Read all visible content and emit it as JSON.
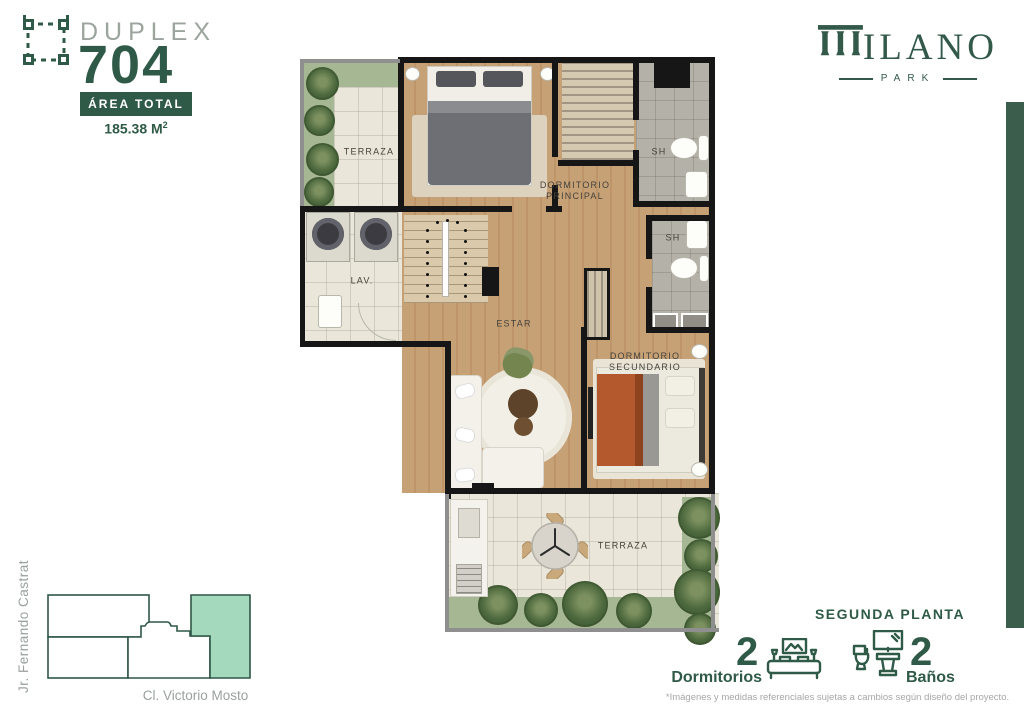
{
  "header": {
    "unit_type": "DUPLEX",
    "unit_number": "704",
    "area_label": "ÁREA TOTAL",
    "area_value": "185.38 M",
    "area_sup": "2",
    "icon": "plan-outline-icon"
  },
  "brand": {
    "name_initial": "M",
    "name_rest": "ILANO",
    "subtitle": "PARK",
    "color": "#33594a"
  },
  "floor_plan": {
    "rooms": {
      "terraza_top": "TERRAZA",
      "dormitorio_principal": [
        "DORMITORIO",
        "PRINCIPAL"
      ],
      "sh1": "SH",
      "sh2": "SH",
      "lavanderia": "LAV.",
      "estar": "ESTAR",
      "dormitorio_secundario": [
        "DORMITORIO",
        "SECUNDARIO"
      ],
      "terraza_bottom": "TERRAZA"
    }
  },
  "location_map": {
    "street_left": "Jr. Fernando Castrat",
    "street_bottom": "Cl. Victorio Mosto",
    "highlight_color": "#a5d9be"
  },
  "footer": {
    "floor_label": "SEGUNDA PLANTA",
    "bedrooms": {
      "count": "2",
      "label": "Dormitorios",
      "icon": "bed-icon"
    },
    "bathrooms": {
      "count": "2",
      "label": "Baños",
      "icon": "bath-icon"
    },
    "disclaimer": "*Imágenes y medidas referenciales sujetas a cambios según diseño del proyecto."
  },
  "colors": {
    "brand_green": "#2f5a47",
    "accent_bar": "#3a5e4b",
    "muted_text": "#9aa0a0"
  }
}
